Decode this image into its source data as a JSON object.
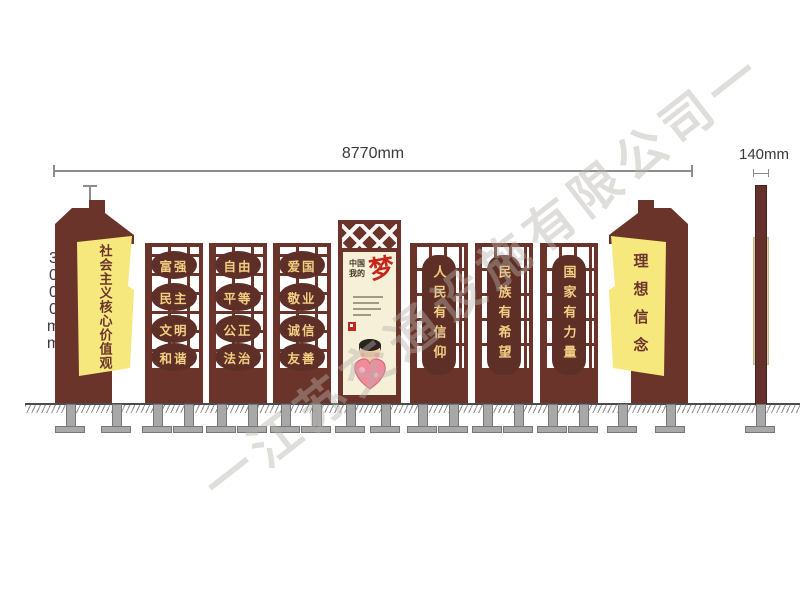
{
  "drawing": {
    "dimensions": {
      "width": "8770mm",
      "height": "3000mm",
      "side_width": "140mm"
    },
    "watermark": "一江苏交通设施有限公司一",
    "left_totem": {
      "text": "社会主义核心价值观"
    },
    "right_totem": {
      "text": "理想信念"
    },
    "value_panels": [
      {
        "words": [
          "富强",
          "民主",
          "文明",
          "和谐"
        ]
      },
      {
        "words": [
          "自由",
          "平等",
          "公正",
          "法治"
        ]
      },
      {
        "words": [
          "爱国",
          "敬业",
          "诚信",
          "友善"
        ]
      }
    ],
    "slogan_panels": [
      {
        "text": "人民有信仰"
      },
      {
        "text": "民族有希望"
      },
      {
        "text": "国家有力量"
      }
    ],
    "poster": {
      "title_line1": "中国",
      "title_line2": "我的",
      "dream_char": "梦"
    },
    "colors": {
      "panel_brown": "#6b342b",
      "medallion_brown": "#5e2f26",
      "accent_gold": "#f3cf84",
      "pennant_yellow": "#f6e87d",
      "poster_cream": "#f6f0d9",
      "dream_red": "#c3261b",
      "foot_gray": "#a8a8a8"
    }
  }
}
